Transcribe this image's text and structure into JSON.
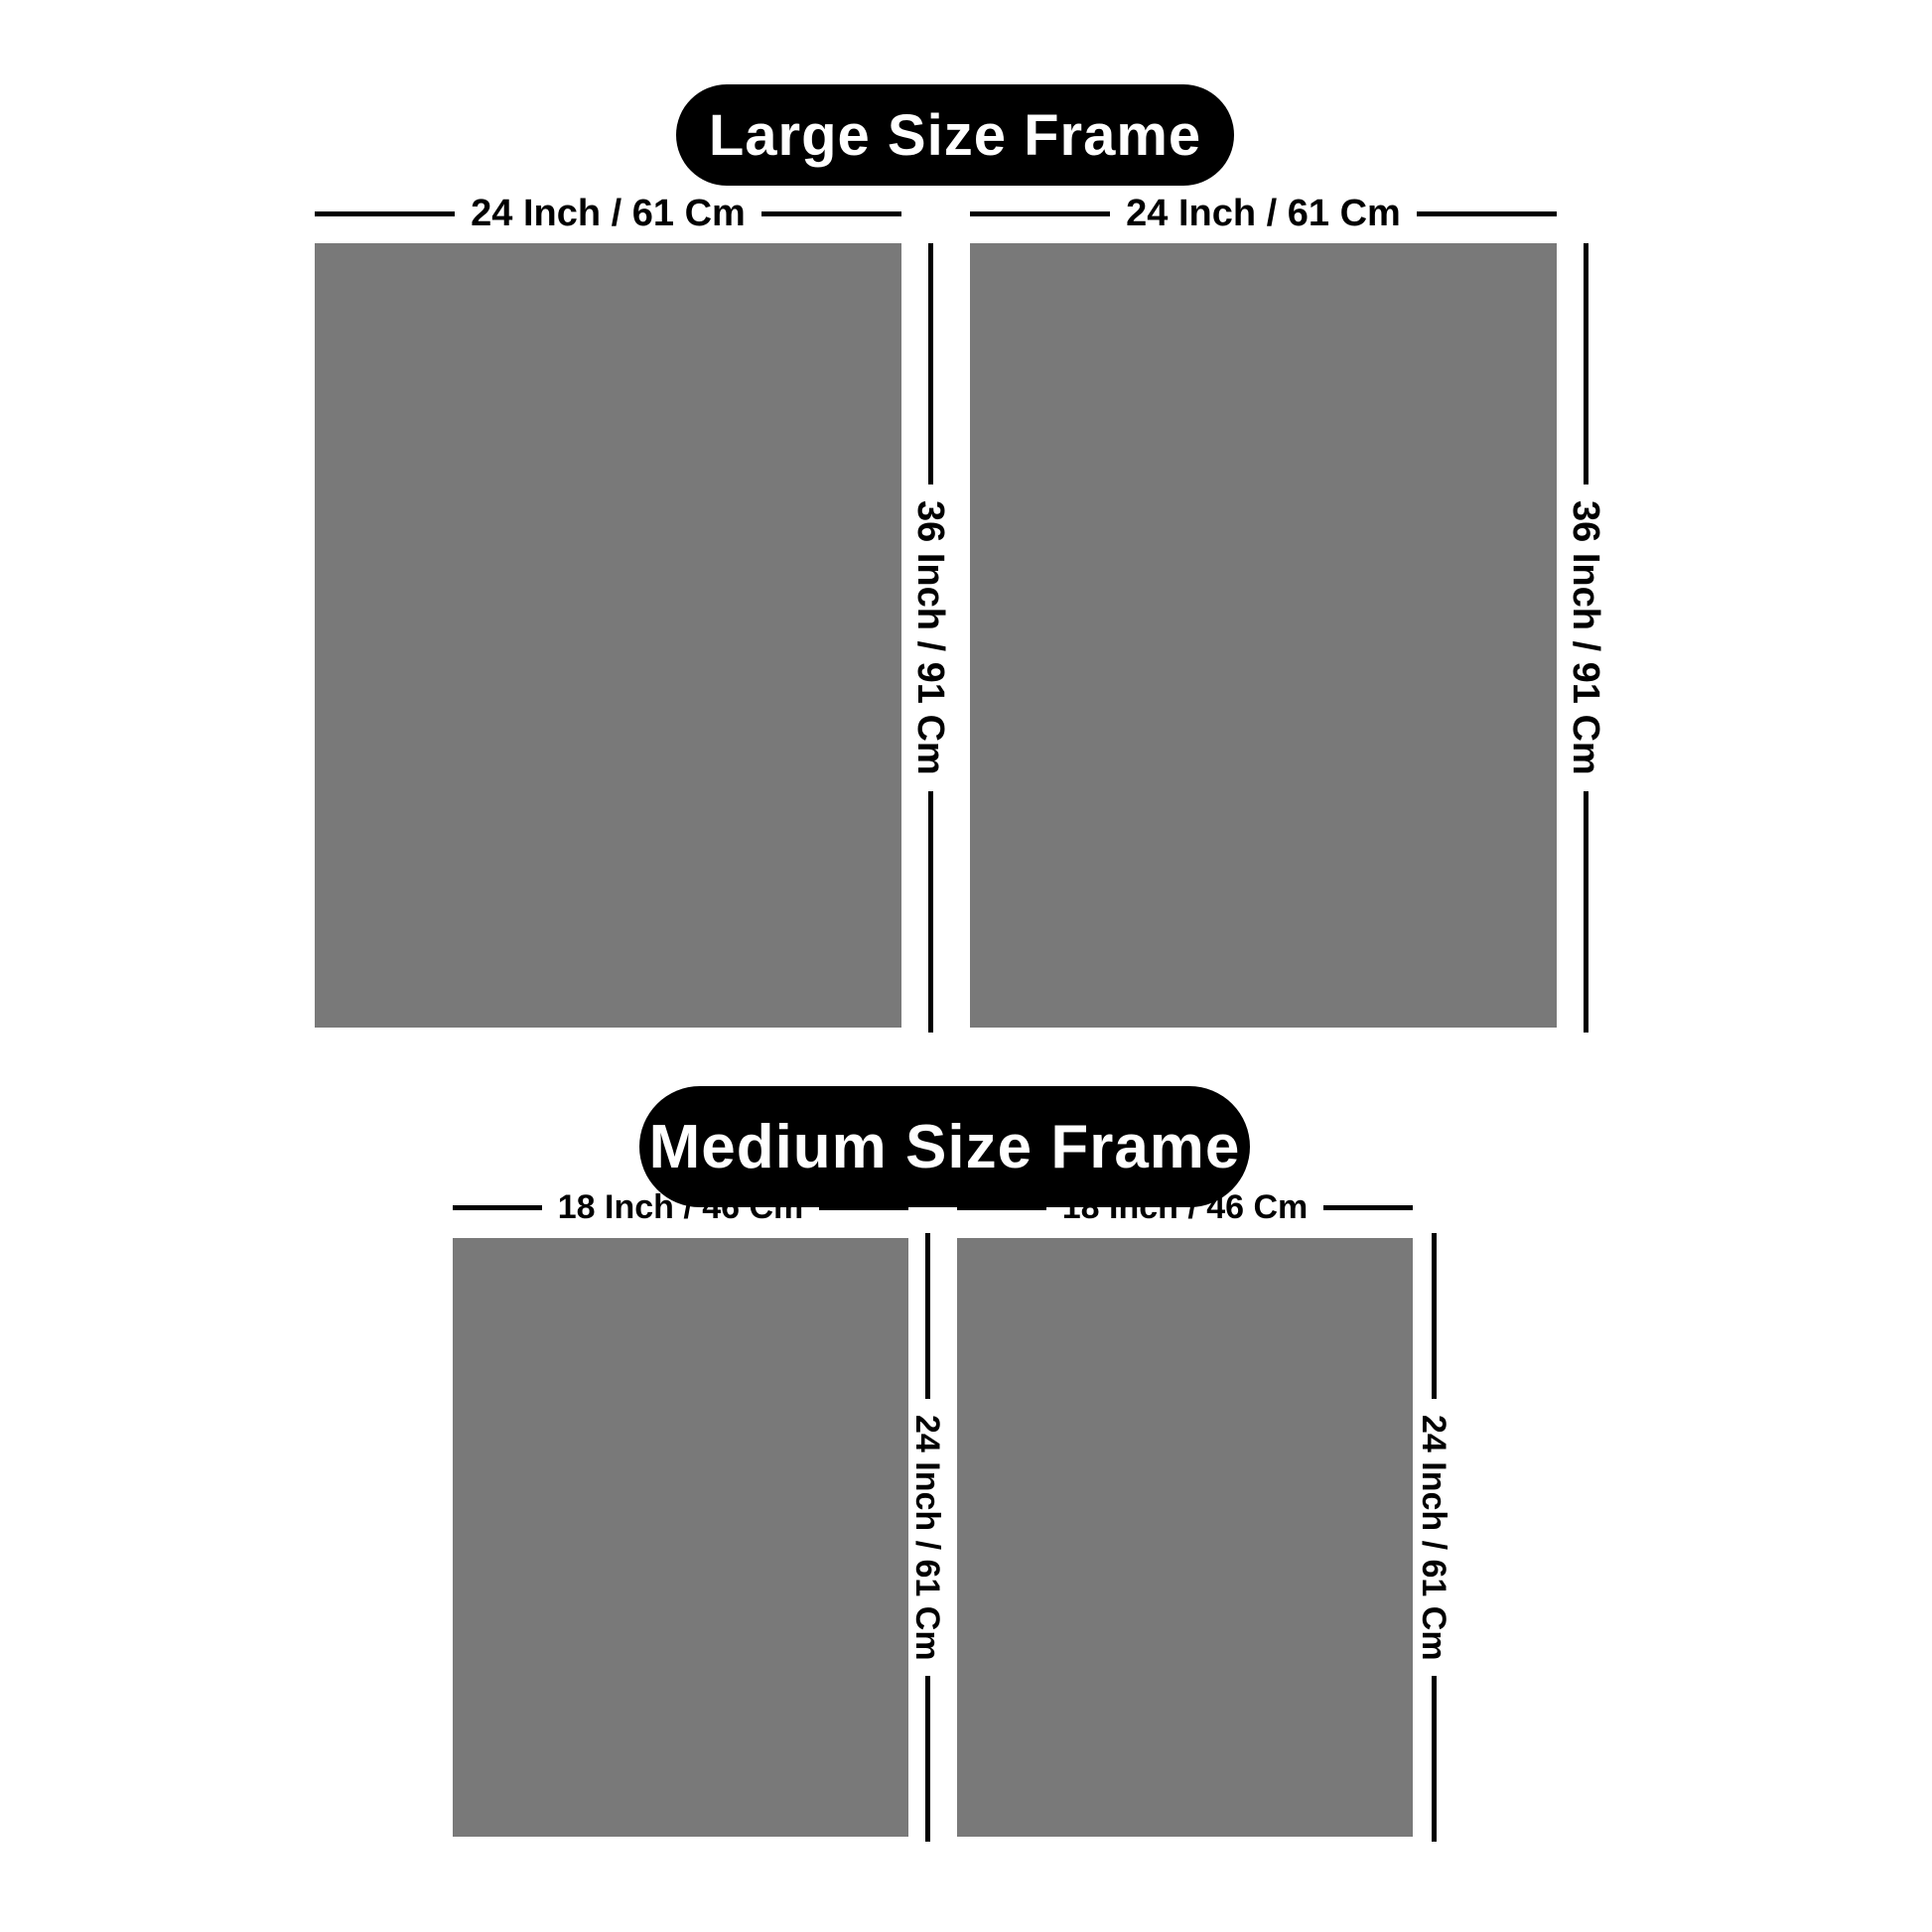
{
  "colors": {
    "background": "#ffffff",
    "frame_fill": "#797979",
    "dimension_line": "#000000",
    "pill_background": "#000000",
    "pill_text": "#ffffff"
  },
  "sections": [
    {
      "title": "Large Size Frame",
      "frames": [
        {
          "width_label": "24 Inch / 61 Cm",
          "height_label": "36 Inch / 91 Cm"
        },
        {
          "width_label": "24 Inch / 61 Cm",
          "height_label": "36 Inch / 91 Cm"
        }
      ]
    },
    {
      "title": "Medium Size Frame",
      "frames": [
        {
          "width_label": "18 Inch / 46 Cm",
          "height_label": "24 Inch / 61 Cm"
        },
        {
          "width_label": "18 Inch / 46 Cm",
          "height_label": "24 Inch / 61 Cm"
        }
      ]
    }
  ]
}
